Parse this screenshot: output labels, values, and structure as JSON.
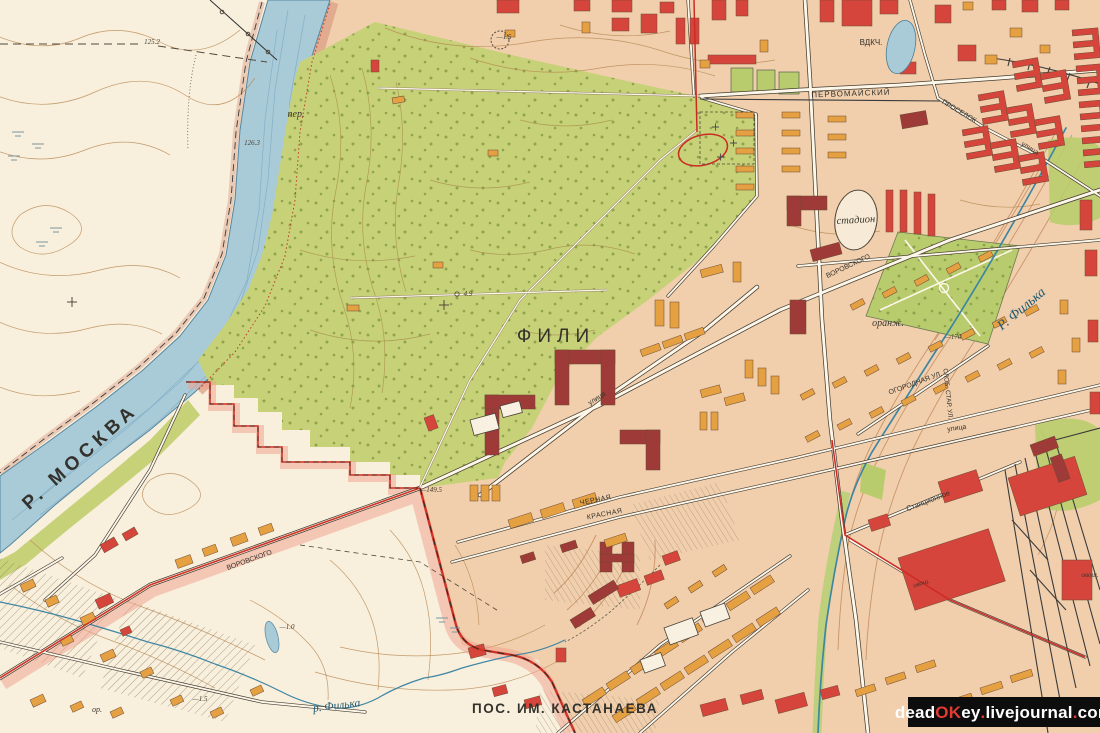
{
  "colors": {
    "builtup": "#f1cfad",
    "floodplain": "#f8efdc",
    "park": "#c7d178",
    "park_dark": "#b9cc6d",
    "river": "#a9cbd8",
    "river_edge": "#54869e",
    "bank": "#dc9f85",
    "boundary_red": "#cf3427",
    "boundary_glow": "#f2a18e",
    "tram": "#cc2b24",
    "buildings": {
      "r": "#d6453c",
      "m": "#9e3a38",
      "o": "#e5a042",
      "w": "#f8f0e0"
    }
  },
  "labels": {
    "river_moskva": "Р. МОСКВА",
    "fili": "ФИЛИ",
    "pos_kastanaeva": "ПОС. ИМ. КАСТАНАЕВА",
    "river_filka": "Р. Филька",
    "river_filka_small": "р. Филька",
    "pervomaysky": "ПЕРВОМАЙСКИЙ",
    "vdkch": "ВДКЧ.",
    "stadion": "стадион",
    "oranzh": "оранж.",
    "per": "пер.",
    "stantsionnoe": "Станционное",
    "chernaya": "ЧЕРНАЯ",
    "krasnaya": "КРАСНАЯ",
    "ogorodnaya": "ОГОРОДНАЯ УЛ.",
    "slob_star": "СЛОБ. СТАР. УЛ.",
    "vorovskogo": "ВОРОВСКОГО",
    "proselok": "ПРОСЕЛОК",
    "ulitsa": "улица",
    "ovosh": "овощ.",
    "or_label": "ор.",
    "elev_125": "125.2",
    "elev_126": "126.3",
    "elev_149": "—149.5",
    "elev_170": "—170",
    "elev_49": "4.9",
    "elev_n15": "—1.5",
    "elev_n10": "—1.0"
  },
  "watermark": {
    "p1": "dead",
    "p2": "OK",
    "p3": "ey",
    "p4": ".",
    "p5": "livejournal",
    "p6": ".",
    "p7": "com"
  },
  "buildings": {
    "r": [
      [
        497,
        0,
        22,
        13,
        0
      ],
      [
        574,
        0,
        16,
        11,
        0
      ],
      [
        612,
        0,
        20,
        12,
        0
      ],
      [
        641,
        14,
        16,
        19,
        0
      ],
      [
        612,
        18,
        17,
        13,
        0
      ],
      [
        660,
        2,
        14,
        11,
        0
      ],
      [
        708,
        55,
        48,
        9,
        0
      ],
      [
        676,
        18,
        9,
        26,
        0
      ],
      [
        690,
        18,
        9,
        26,
        0
      ],
      [
        371,
        60,
        8,
        12,
        0
      ],
      [
        712,
        0,
        14,
        20,
        0
      ],
      [
        736,
        0,
        12,
        16,
        0
      ],
      [
        820,
        0,
        14,
        22,
        0
      ],
      [
        842,
        0,
        30,
        26,
        0
      ],
      [
        880,
        0,
        18,
        14,
        0
      ],
      [
        935,
        5,
        16,
        18,
        0
      ],
      [
        958,
        45,
        18,
        16,
        0
      ],
      [
        900,
        62,
        16,
        12,
        0
      ],
      [
        992,
        0,
        14,
        10,
        0
      ],
      [
        1022,
        0,
        16,
        12,
        0
      ],
      [
        1055,
        0,
        14,
        10,
        0
      ],
      [
        886,
        190,
        7,
        42,
        0
      ],
      [
        900,
        190,
        7,
        42,
        0
      ],
      [
        914,
        192,
        7,
        42,
        0
      ],
      [
        928,
        194,
        7,
        42,
        0
      ],
      [
        424,
        418,
        10,
        14,
        -20
      ],
      [
        468,
        648,
        16,
        11,
        -15
      ],
      [
        492,
        688,
        14,
        9,
        -15
      ],
      [
        524,
        700,
        16,
        9,
        -15
      ],
      [
        556,
        648,
        10,
        14,
        0
      ],
      [
        616,
        586,
        22,
        12,
        -20
      ],
      [
        644,
        576,
        18,
        10,
        -20
      ],
      [
        662,
        556,
        16,
        10,
        -20
      ],
      [
        700,
        705,
        26,
        12,
        -15
      ],
      [
        740,
        695,
        22,
        10,
        -15
      ],
      [
        775,
        700,
        30,
        14,
        -15
      ],
      [
        820,
        690,
        18,
        10,
        -15
      ],
      [
        898,
        558,
        95,
        55,
        -18
      ],
      [
        1008,
        478,
        70,
        40,
        -18
      ],
      [
        938,
        482,
        40,
        22,
        -18
      ],
      [
        868,
        520,
        20,
        12,
        -18
      ],
      [
        1062,
        560,
        30,
        40,
        0
      ],
      [
        1080,
        200,
        12,
        30,
        0
      ],
      [
        1085,
        250,
        12,
        26,
        0
      ],
      [
        1088,
        320,
        10,
        22,
        0
      ],
      [
        1090,
        392,
        10,
        22,
        0
      ],
      [
        95,
        600,
        16,
        10,
        -25
      ],
      [
        120,
        630,
        10,
        7,
        -25
      ],
      [
        100,
        545,
        16,
        9,
        -30
      ],
      [
        122,
        534,
        14,
        8,
        -30
      ]
    ],
    "m": [
      [
        787,
        196,
        40,
        14,
        0
      ],
      [
        787,
        196,
        14,
        30,
        0
      ],
      [
        485,
        395,
        14,
        60,
        0
      ],
      [
        485,
        395,
        50,
        14,
        0
      ],
      [
        555,
        350,
        60,
        14,
        0
      ],
      [
        555,
        350,
        14,
        55,
        0
      ],
      [
        601,
        350,
        14,
        55,
        0
      ],
      [
        620,
        430,
        40,
        14,
        0
      ],
      [
        646,
        430,
        14,
        40,
        0
      ],
      [
        600,
        542,
        12,
        30,
        0
      ],
      [
        622,
        542,
        12,
        30,
        0
      ],
      [
        600,
        554,
        34,
        8,
        0
      ],
      [
        560,
        545,
        16,
        8,
        -18
      ],
      [
        520,
        556,
        14,
        8,
        -18
      ],
      [
        790,
        300,
        16,
        34,
        0
      ],
      [
        810,
        250,
        30,
        12,
        -15
      ],
      [
        900,
        115,
        26,
        14,
        -10
      ],
      [
        1030,
        445,
        26,
        12,
        -20
      ],
      [
        1050,
        458,
        12,
        26,
        -20
      ],
      [
        588,
        596,
        30,
        10,
        -32
      ],
      [
        570,
        620,
        24,
        10,
        -32
      ]
    ],
    "o": [
      [
        582,
        22,
        8,
        11,
        0
      ],
      [
        505,
        30,
        10,
        7,
        0
      ],
      [
        760,
        40,
        8,
        12,
        0
      ],
      [
        700,
        60,
        10,
        8,
        0
      ],
      [
        963,
        2,
        10,
        8,
        0
      ],
      [
        1010,
        28,
        12,
        9,
        0
      ],
      [
        985,
        55,
        12,
        9,
        0
      ],
      [
        1040,
        45,
        10,
        8,
        0
      ],
      [
        736,
        112,
        18,
        6,
        0
      ],
      [
        736,
        130,
        18,
        6,
        0
      ],
      [
        736,
        148,
        18,
        6,
        0
      ],
      [
        736,
        166,
        18,
        6,
        0
      ],
      [
        736,
        184,
        18,
        6,
        0
      ],
      [
        782,
        112,
        18,
        6,
        0
      ],
      [
        782,
        130,
        18,
        6,
        0
      ],
      [
        782,
        148,
        18,
        6,
        0
      ],
      [
        782,
        166,
        18,
        6,
        0
      ],
      [
        828,
        116,
        18,
        6,
        0
      ],
      [
        828,
        134,
        18,
        6,
        0
      ],
      [
        828,
        152,
        18,
        6,
        0
      ],
      [
        655,
        300,
        9,
        26,
        0
      ],
      [
        670,
        302,
        9,
        26,
        0
      ],
      [
        700,
        270,
        22,
        8,
        -15
      ],
      [
        733,
        262,
        8,
        20,
        0
      ],
      [
        745,
        360,
        8,
        18,
        0
      ],
      [
        758,
        368,
        8,
        18,
        0
      ],
      [
        771,
        376,
        8,
        18,
        0
      ],
      [
        700,
        390,
        20,
        8,
        -15
      ],
      [
        724,
        398,
        20,
        8,
        -15
      ],
      [
        470,
        485,
        8,
        16,
        0
      ],
      [
        481,
        485,
        8,
        16,
        0
      ],
      [
        492,
        485,
        8,
        16,
        0
      ],
      [
        508,
        520,
        24,
        9,
        -18
      ],
      [
        540,
        510,
        24,
        9,
        -18
      ],
      [
        572,
        500,
        24,
        9,
        -18
      ],
      [
        604,
        540,
        22,
        8,
        -18
      ],
      [
        640,
        350,
        20,
        7,
        -20
      ],
      [
        662,
        342,
        20,
        7,
        -20
      ],
      [
        684,
        334,
        20,
        7,
        -20
      ],
      [
        700,
        412,
        7,
        18,
        0
      ],
      [
        711,
        412,
        7,
        18,
        0
      ],
      [
        850,
        305,
        14,
        6,
        -28
      ],
      [
        882,
        293,
        14,
        6,
        -28
      ],
      [
        914,
        281,
        14,
        6,
        -28
      ],
      [
        946,
        269,
        14,
        6,
        -28
      ],
      [
        978,
        257,
        14,
        6,
        -28
      ],
      [
        800,
        395,
        14,
        6,
        -28
      ],
      [
        832,
        383,
        14,
        6,
        -28
      ],
      [
        864,
        371,
        14,
        6,
        -28
      ],
      [
        896,
        359,
        14,
        6,
        -28
      ],
      [
        928,
        347,
        14,
        6,
        -28
      ],
      [
        960,
        335,
        14,
        6,
        -28
      ],
      [
        992,
        323,
        14,
        6,
        -28
      ],
      [
        1024,
        311,
        14,
        6,
        -28
      ],
      [
        805,
        437,
        14,
        6,
        -28
      ],
      [
        837,
        425,
        14,
        6,
        -28
      ],
      [
        869,
        413,
        14,
        6,
        -28
      ],
      [
        901,
        401,
        14,
        6,
        -28
      ],
      [
        933,
        389,
        14,
        6,
        -28
      ],
      [
        965,
        377,
        14,
        6,
        -28
      ],
      [
        997,
        365,
        14,
        6,
        -28
      ],
      [
        1029,
        353,
        14,
        6,
        -28
      ],
      [
        582,
        700,
        24,
        8,
        -33
      ],
      [
        606,
        684,
        24,
        8,
        -33
      ],
      [
        630,
        668,
        24,
        8,
        -33
      ],
      [
        654,
        652,
        24,
        8,
        -33
      ],
      [
        678,
        636,
        24,
        8,
        -33
      ],
      [
        702,
        620,
        24,
        8,
        -33
      ],
      [
        726,
        604,
        24,
        8,
        -33
      ],
      [
        750,
        588,
        24,
        8,
        -33
      ],
      [
        612,
        716,
        24,
        8,
        -33
      ],
      [
        636,
        700,
        24,
        8,
        -33
      ],
      [
        660,
        684,
        24,
        8,
        -33
      ],
      [
        684,
        668,
        24,
        8,
        -33
      ],
      [
        708,
        652,
        24,
        8,
        -33
      ],
      [
        732,
        636,
        24,
        8,
        -33
      ],
      [
        756,
        620,
        24,
        8,
        -33
      ],
      [
        664,
        604,
        14,
        6,
        -33
      ],
      [
        688,
        588,
        14,
        6,
        -33
      ],
      [
        712,
        572,
        14,
        6,
        -33
      ],
      [
        855,
        690,
        20,
        7,
        -18
      ],
      [
        885,
        678,
        20,
        7,
        -18
      ],
      [
        915,
        666,
        20,
        7,
        -18
      ],
      [
        950,
        700,
        22,
        7,
        -18
      ],
      [
        980,
        688,
        22,
        7,
        -18
      ],
      [
        1010,
        676,
        22,
        7,
        -18
      ],
      [
        20,
        585,
        14,
        8,
        -25
      ],
      [
        45,
        600,
        12,
        8,
        -25
      ],
      [
        80,
        618,
        14,
        8,
        -25
      ],
      [
        60,
        640,
        12,
        7,
        -25
      ],
      [
        100,
        655,
        14,
        8,
        -25
      ],
      [
        140,
        672,
        12,
        7,
        -25
      ],
      [
        30,
        700,
        14,
        8,
        -25
      ],
      [
        70,
        706,
        12,
        7,
        -25
      ],
      [
        110,
        712,
        12,
        7,
        -25
      ],
      [
        170,
        700,
        12,
        7,
        -25
      ],
      [
        210,
        712,
        12,
        7,
        -25
      ],
      [
        250,
        690,
        12,
        7,
        -25
      ],
      [
        175,
        560,
        16,
        9,
        -20
      ],
      [
        202,
        549,
        14,
        8,
        -20
      ],
      [
        230,
        538,
        16,
        9,
        -20
      ],
      [
        258,
        528,
        14,
        8,
        -20
      ],
      [
        392,
        98,
        12,
        6,
        -10
      ],
      [
        488,
        150,
        10,
        6,
        0
      ],
      [
        433,
        262,
        10,
        6,
        0
      ],
      [
        347,
        305,
        12,
        6,
        0
      ],
      [
        1060,
        300,
        8,
        14,
        0
      ],
      [
        1072,
        338,
        8,
        14,
        0
      ],
      [
        1058,
        370,
        8,
        14,
        0
      ]
    ],
    "w": [
      [
        470,
        420,
        26,
        16,
        -15
      ],
      [
        500,
        406,
        20,
        12,
        -15
      ],
      [
        664,
        628,
        30,
        18,
        -20
      ],
      [
        700,
        612,
        26,
        16,
        -20
      ],
      [
        640,
        660,
        22,
        14,
        -20
      ]
    ]
  },
  "eshapes": [
    [
      1012,
      62,
      -10
    ],
    [
      1040,
      74,
      -10
    ],
    [
      978,
      95,
      -10
    ],
    [
      1006,
      108,
      -10
    ],
    [
      1034,
      120,
      -10
    ],
    [
      962,
      130,
      -10
    ],
    [
      990,
      143,
      -10
    ],
    [
      1018,
      156,
      -10
    ],
    [
      1072,
      30,
      -5
    ],
    [
      1076,
      66,
      -5
    ],
    [
      1079,
      102,
      -5
    ],
    [
      1082,
      138,
      -5
    ]
  ]
}
